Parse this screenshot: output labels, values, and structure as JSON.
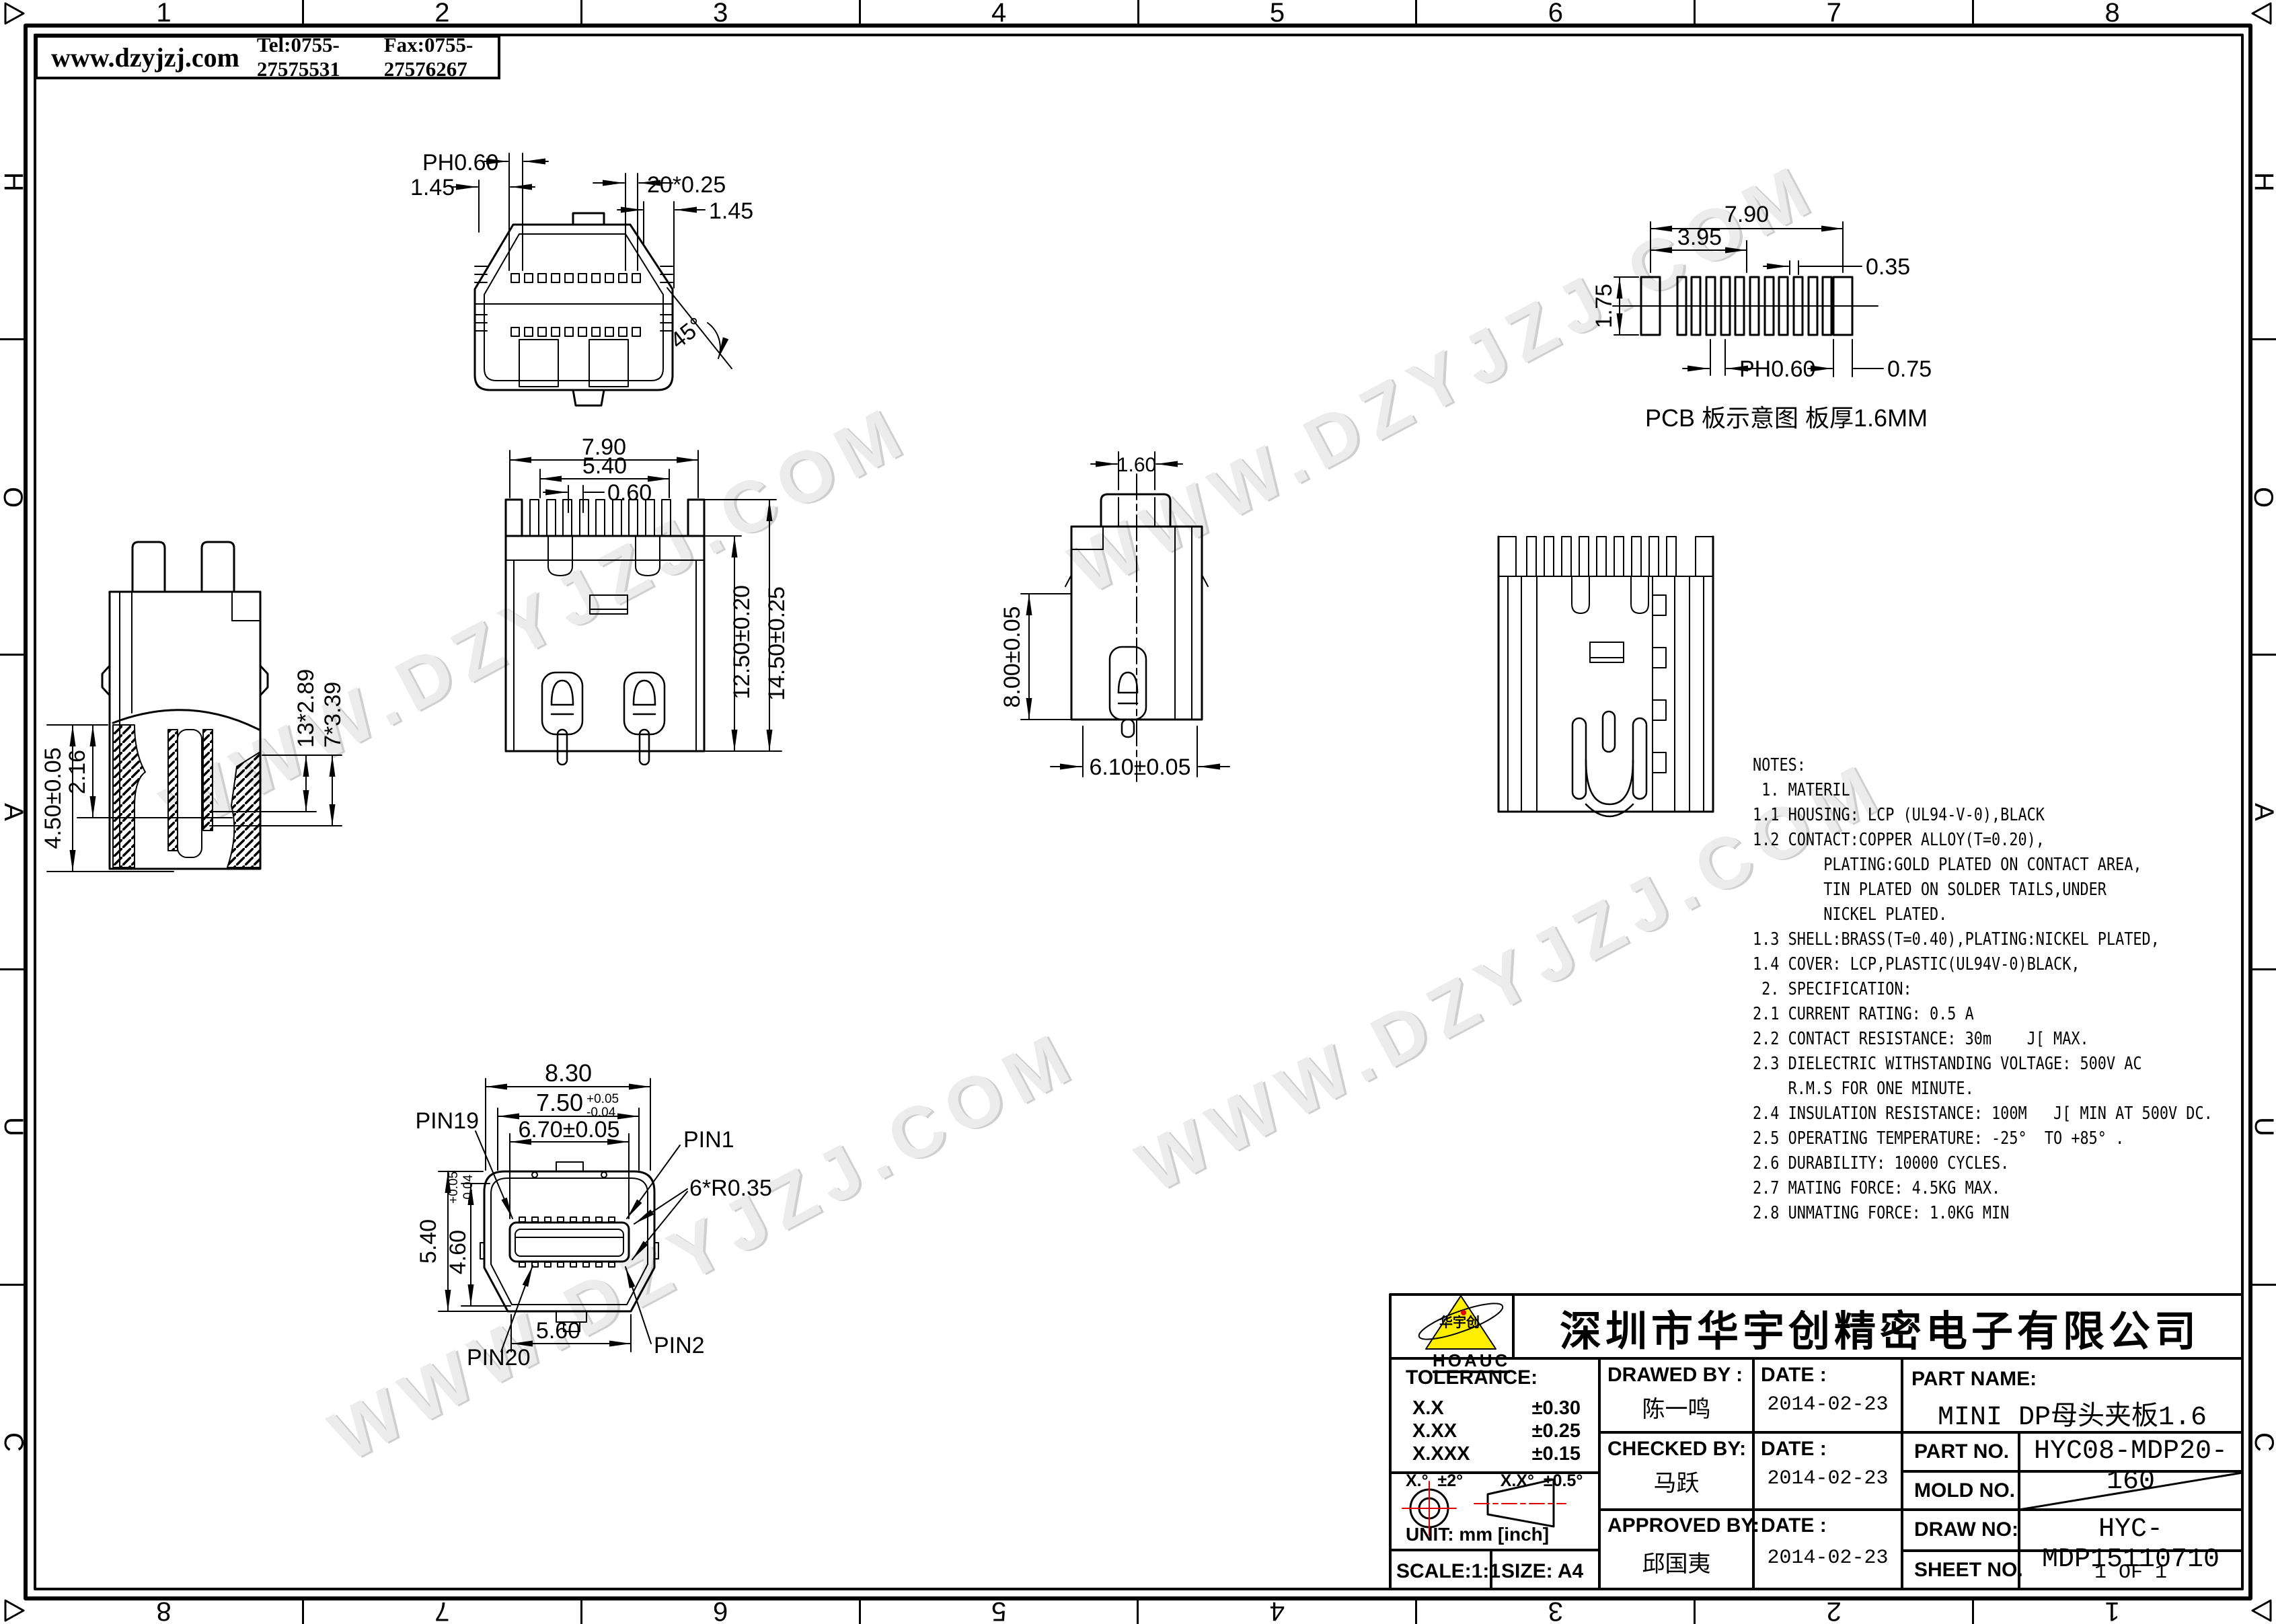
{
  "header": {
    "site": "www.dzyjzj.com",
    "tel": "Tel:0755-27575531",
    "fax": "Fax:0755-27576267"
  },
  "watermark": {
    "text": "WWW.DZYJZJ.COM"
  },
  "border": {
    "top_numbers": [
      "1",
      "2",
      "3",
      "4",
      "5",
      "6",
      "7",
      "8"
    ],
    "side_letters": [
      "H",
      "O",
      "A",
      "U",
      "C"
    ]
  },
  "views": {
    "top": {
      "dims": {
        "ph": "PH0.60",
        "d145l": "1.45",
        "pitch": "20*0.25",
        "d145r": "1.45",
        "angle": "45°"
      }
    },
    "pcb": {
      "dims": {
        "w": "7.90",
        "half": "3.95",
        "h": "1.75",
        "pad": "0.35",
        "pitch": "PH0.60",
        "end": "0.75"
      },
      "caption": "PCB 板示意图 板厚1.6MM"
    },
    "side_left": {
      "dims": {
        "h450": "4.50±0.05",
        "h216": "2.16",
        "p289": "13*2.89",
        "p339": "7*3.39"
      }
    },
    "front": {
      "dims": {
        "w790": "7.90",
        "w540": "5.40",
        "p060": "0.60",
        "h1250": "12.50±0.20",
        "h1450": "14.50±0.25"
      }
    },
    "side_right": {
      "dims": {
        "w160": "1.60",
        "h800": "8.00±0.05",
        "w610": "6.10±0.05"
      }
    },
    "face": {
      "dims": {
        "w830": "8.30",
        "w750": "7.50",
        "tol_up": "+0.05",
        "tol_dn": "-0.04",
        "w670": "6.70±0.05",
        "r": "6*R0.35",
        "h540": "5.40",
        "h460": "4.60",
        "w560": "5.60"
      },
      "pins": {
        "p19": "PIN19",
        "p1": "PIN1",
        "p20": "PIN20",
        "p2": "PIN2"
      }
    }
  },
  "notes": {
    "text": "NOTES:\n 1. MATERIL\n1.1 HOUSING: LCP (UL94-V-0),BLACK\n1.2 CONTACT:COPPER ALLOY(T=0.20),\n        PLATING:GOLD PLATED ON CONTACT AREA,\n        TIN PLATED ON SOLDER TAILS,UNDER\n        NICKEL PLATED.\n1.3 SHELL:BRASS(T=0.40),PLATING:NICKEL PLATED,\n1.4 COVER: LCP,PLASTIC(UL94V-0)BLACK,\n 2. SPECIFICATION:\n2.1 CURRENT RATING: 0.5 A\n2.2 CONTACT RESISTANCE: 30m    J[ MAX.\n2.3 DIELECTRIC WITHSTANDING VOLTAGE: 500V AC\n    R.M.S FOR ONE MINUTE.\n2.4 INSULATION RESISTANCE: 100M   J[ MIN AT 500V DC.\n2.5 OPERATING TEMPERATURE: -25°  TO +85° .\n2.6 DURABILITY: 10000 CYCLES.\n2.7 MATING FORCE: 4.5KG MAX.\n2.8 UNMATING FORCE: 1.0KG MIN"
  },
  "title_block": {
    "company": "深圳市华宇创精密电子有限公司",
    "logo_text": "华宇创",
    "logo_sub": "HOAUC",
    "tolerance_label": "TOLERANCE:",
    "tol_rows": [
      [
        "X.X",
        "±0.30"
      ],
      [
        "X.XX",
        "±0.25"
      ],
      [
        "X.XXX",
        "±0.15"
      ]
    ],
    "tol_angles": "X.°  ±2°        X.X°  ±0.5°",
    "unit": "UNIT:  mm  [inch]",
    "scale": "SCALE:1:1",
    "size": "SIZE:  A4",
    "drawed_by_label": "DRAWED BY :",
    "drawed_by": "陈一鸣",
    "checked_by_label": "CHECKED BY:",
    "checked_by": "马跃",
    "approved_by_label": "APPROVED BY:",
    "approved_by": "邱国夷",
    "date_label": "DATE :",
    "dates": {
      "drawed": "2014-02-23",
      "checked": "2014-02-23",
      "approved": "2014-02-23"
    },
    "part_name_label": "PART NAME:",
    "part_name": "MINI DP母头夹板1.6",
    "part_no_label": "PART NO.",
    "part_no": "HYC08-MDP20-160",
    "mold_no_label": "MOLD NO.",
    "mold_no": "",
    "draw_no_label": "DRAW NO:",
    "draw_no": "HYC-MDP15110710",
    "sheet_no_label": "SHEET NO.",
    "sheet_no": "1 OF 1"
  },
  "colors": {
    "line": "#000000",
    "accent_red": "#e00000",
    "logo_yellow": "#ffee00",
    "watermark": "#ececec"
  }
}
